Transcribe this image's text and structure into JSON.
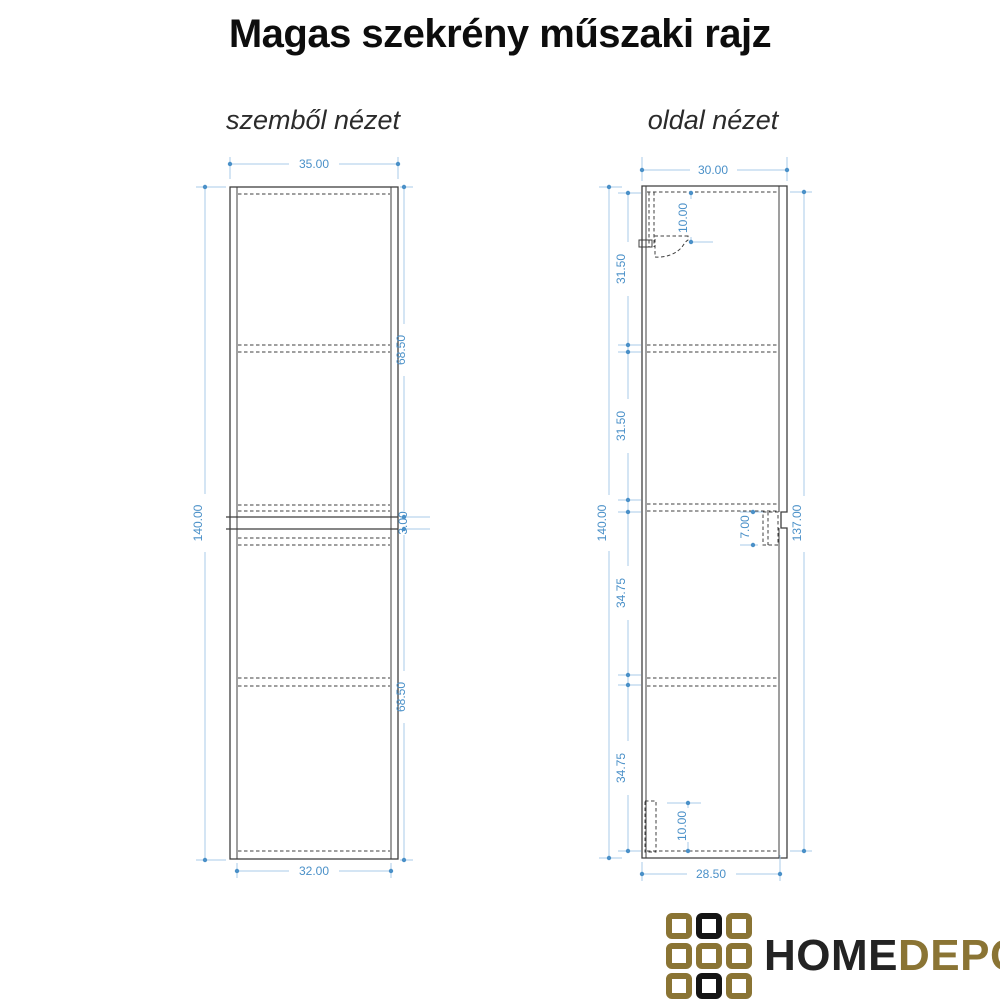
{
  "title": "Magas szekrény műszaki rajz",
  "front_view": {
    "label": "szemből nézet",
    "dims": {
      "outer_width": "35.00",
      "outer_height": "140.00",
      "upper_door_height": "68.50",
      "door_gap": "3.00",
      "lower_door_height": "68.50",
      "inner_width": "32.00"
    }
  },
  "side_view": {
    "label": "oldal nézet",
    "dims": {
      "outer_depth": "30.00",
      "outer_height": "140.00",
      "front_panel_height": "137.00",
      "section_1": "31.50",
      "section_2": "31.50",
      "section_3": "34.75",
      "section_4": "34.75",
      "top_bracket_offset": "10.00",
      "mid_bracket_height": "7.00",
      "bottom_bracket_height": "10.00",
      "body_depth": "28.50"
    }
  },
  "logo": {
    "home": "HOME",
    "depo": "DEPO",
    "gold_color": "#8a7434",
    "black_color": "#141414"
  },
  "colors": {
    "background": "#ffffff",
    "drawing_line": "#3f3f3f",
    "dimension_line": "#a9cbe8",
    "dimension_text": "#4a90c8"
  }
}
